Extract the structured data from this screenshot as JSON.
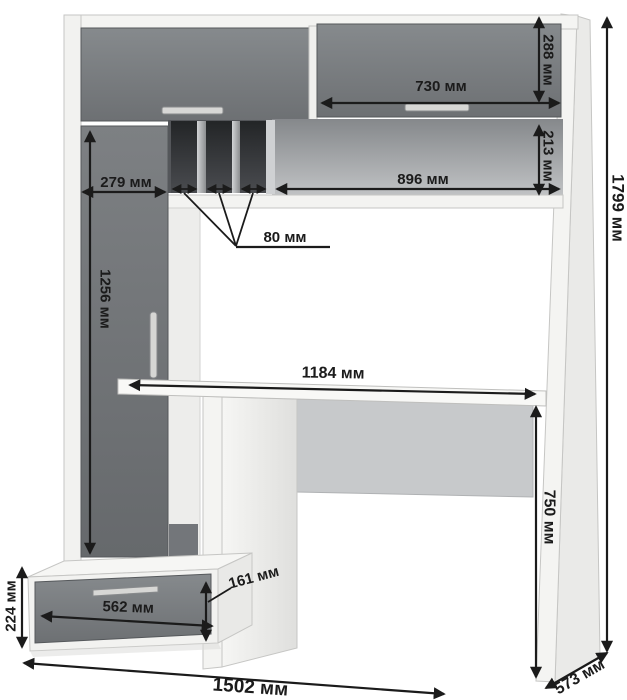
{
  "colors": {
    "annotation": "#1b1b1b",
    "door_gray": "#75787b",
    "carcass_white": "#f2f2f0",
    "background": "#ffffff"
  },
  "dims": {
    "wall_door_height": "288 мм",
    "wall_door_width": "730 мм",
    "niche_height": "213 мм",
    "niche_width": "896 мм",
    "slot_width": "80 мм",
    "cabinet_width": "279 мм",
    "cabinet_door_height": "1256 мм",
    "desktop_length": "1184 мм",
    "desk_height": "750 мм",
    "overall_height": "1799 мм",
    "pedestal_height": "224 мм",
    "drawer_width": "562 мм",
    "drawer_front_height": "161 мм",
    "overall_width": "1502 мм",
    "depth": "573 мм"
  }
}
